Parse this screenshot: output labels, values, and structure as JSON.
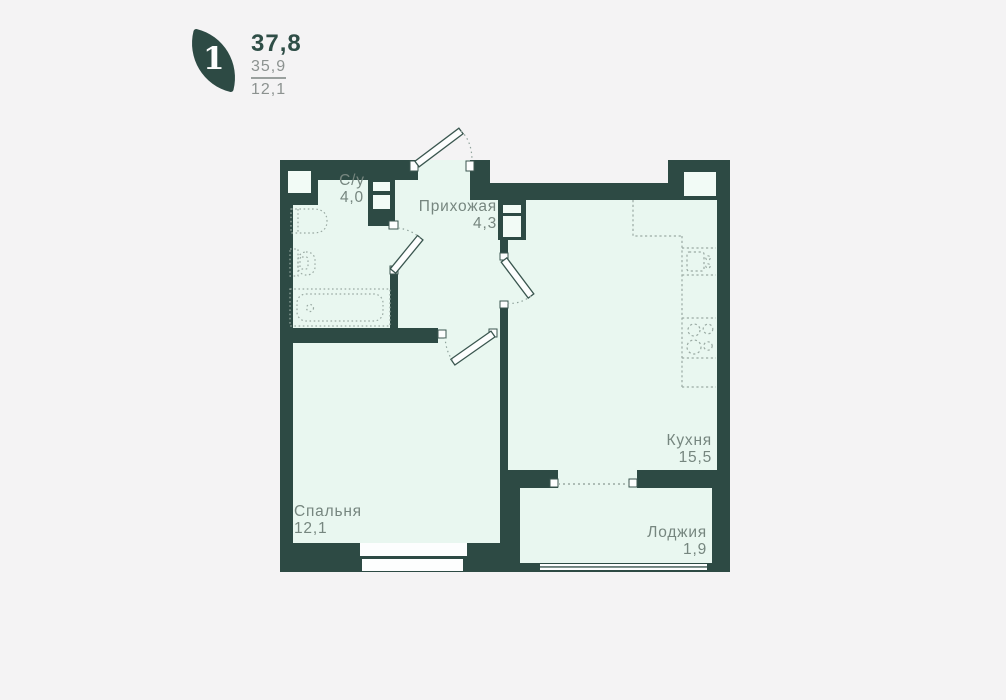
{
  "header": {
    "rooms_count": "1",
    "area_total": "37,8",
    "area_living": "35,9",
    "area_kitchen": "12,1"
  },
  "rooms": [
    {
      "id": "bathroom",
      "name": "С/у",
      "area": "4,0"
    },
    {
      "id": "hallway",
      "name": "Прихожая",
      "area": "4,3"
    },
    {
      "id": "kitchen",
      "name": "Кухня",
      "area": "15,5"
    },
    {
      "id": "bedroom",
      "name": "Спальня",
      "area": "12,1"
    },
    {
      "id": "loggia",
      "name": "Лоджия",
      "area": "1,9"
    }
  ],
  "colors": {
    "wall": "#2d4a44",
    "floor": "#e9f7f0",
    "background": "#f4f3f4",
    "label_text": "#76867f",
    "fixture_line": "#9aaaa3",
    "accent_total": "#2f4e47",
    "secondary_text": "#8c9290"
  }
}
